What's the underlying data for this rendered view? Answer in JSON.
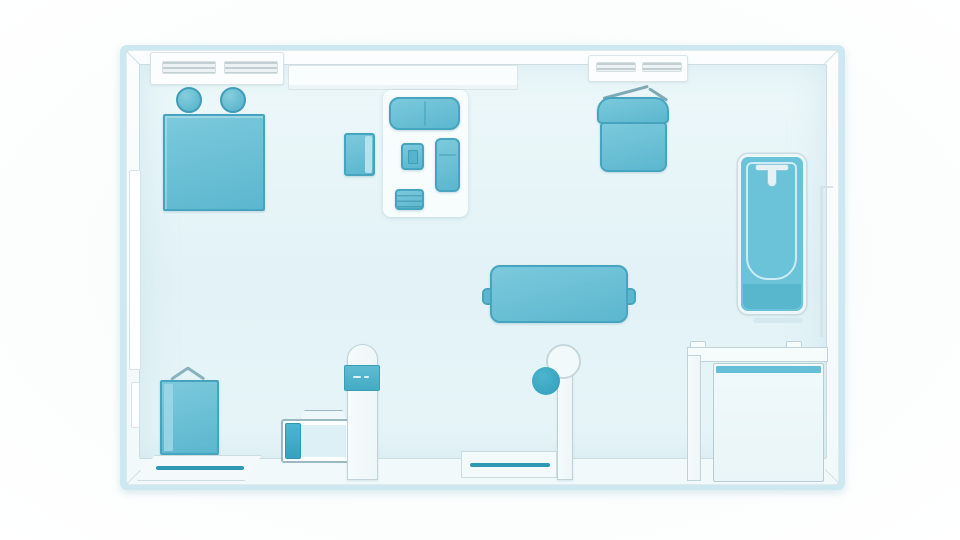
{
  "scene": {
    "kind": "stylized-apartment-floor-plan",
    "view": "top-down",
    "visible_text": ""
  },
  "colors": {
    "teal": "#63c0d7",
    "tealDark": "#47a4bf",
    "tealDeep": "#2e99b4",
    "tealLight": "#a9dcea",
    "band": "#cde8f0",
    "wall": "#f6fafc",
    "wallEdge": "#c9d9de",
    "floorLight": "#ecf7fa",
    "floorDark": "#e0f1f5",
    "background": "#fdfefe"
  },
  "inventory": {
    "bedroom_area": [
      "bed",
      "pillow",
      "pillow",
      "tote-bag"
    ],
    "living_area": [
      "area-rug",
      "loveseat-sofa",
      "armchair",
      "side-chair",
      "chaise",
      "ottoman-table",
      "dining-table",
      "table-chair",
      "table-chair"
    ],
    "work_area": [
      "hanging-chair"
    ],
    "bath_area": [
      "bathtub",
      "bath-mat",
      "shower-tray"
    ],
    "hallway": [
      "storage-cabinet",
      "wall-control-panel",
      "stool",
      "entry-doorway",
      "balcony-doorway"
    ],
    "fixtures": [
      "window-vent",
      "window-sill",
      "window-vent",
      "left-wall-window",
      "left-wall-door",
      "partition-wall",
      "partition-wall",
      "bathroom-partition"
    ]
  }
}
